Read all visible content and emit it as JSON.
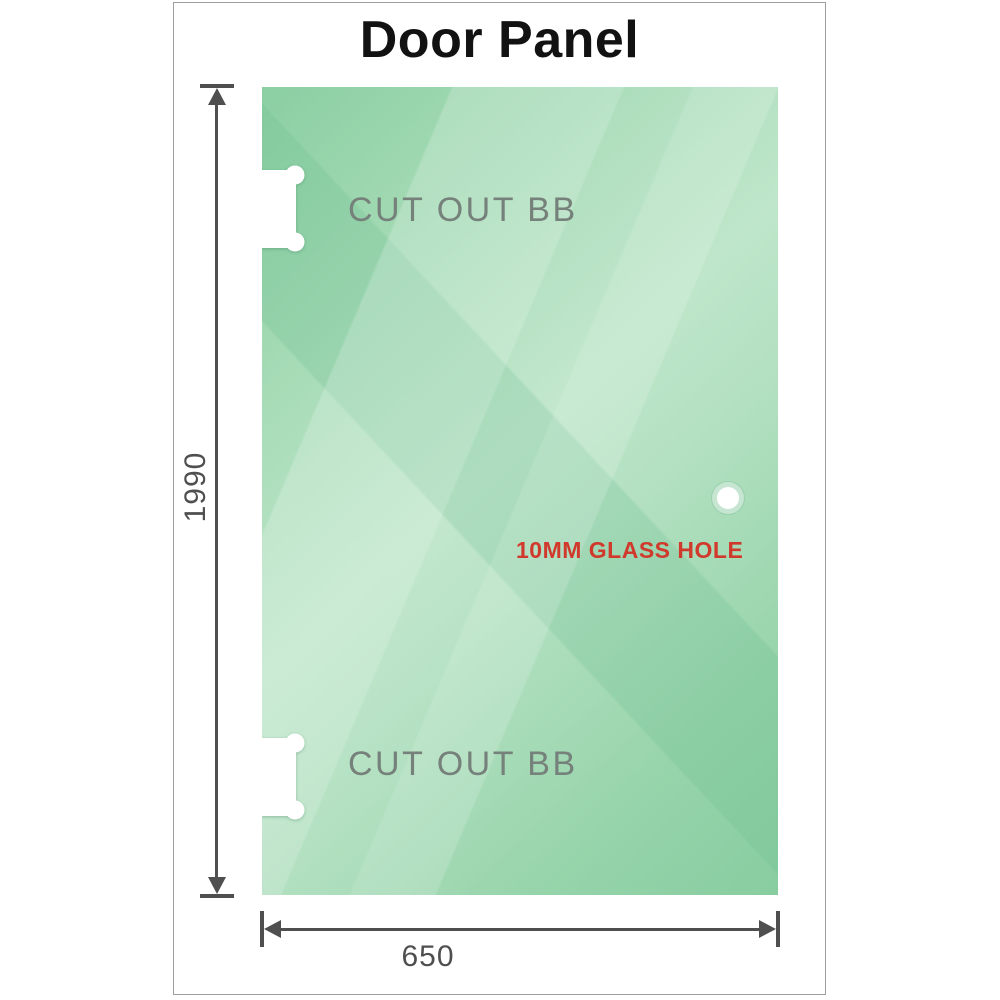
{
  "title": "Door Panel",
  "cutouts": [
    {
      "label": "CUT OUT BB"
    },
    {
      "label": "CUT OUT BB"
    }
  ],
  "glass_hole": {
    "label": "10MM GLASS HOLE",
    "diameter_mm": "10"
  },
  "dimensions": {
    "height_label": "1990",
    "width_label": "650"
  },
  "colors": {
    "glass_green": "#9fd8b1",
    "glass_green_light": "#bfe6ca",
    "hole_label_red": "#d0392c",
    "dimension_gray": "#4f4f4f",
    "cutout_label_gray": "#75817a",
    "frame_border_gray": "#9e9e9e"
  }
}
